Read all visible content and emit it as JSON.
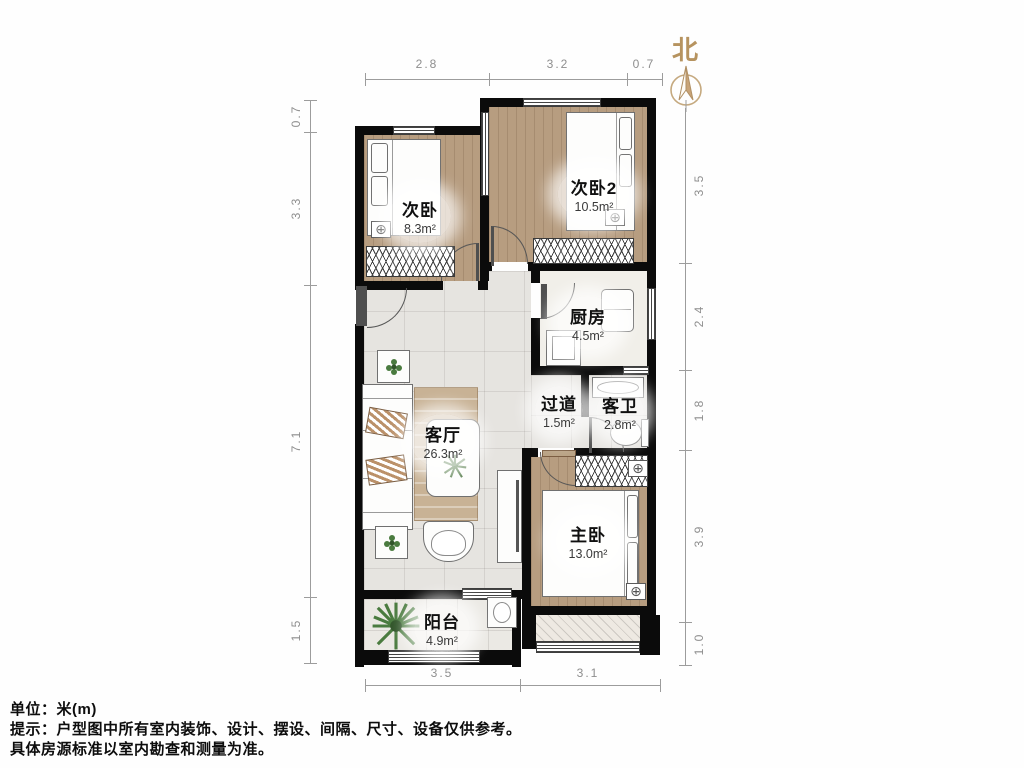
{
  "compass": {
    "north": "北"
  },
  "rooms": [
    {
      "name": "次卧",
      "area": "8.3m²"
    },
    {
      "name": "次卧2",
      "area": "10.5m²"
    },
    {
      "name": "厨房",
      "area": "4.5m²"
    },
    {
      "name": "过道",
      "area": "1.5m²"
    },
    {
      "name": "客卫",
      "area": "2.8m²"
    },
    {
      "name": "客厅",
      "area": "26.3m²"
    },
    {
      "name": "主卧",
      "area": "13.0m²"
    },
    {
      "name": "阳台",
      "area": "4.9m²"
    }
  ],
  "dimensions": {
    "top": [
      "2.8",
      "3.2",
      "0.7"
    ],
    "left": [
      "0.7",
      "3.3",
      "7.1",
      "1.5"
    ],
    "right": [
      "3.5",
      "2.4",
      "1.8",
      "3.9",
      "1.0"
    ],
    "bottom": [
      "3.5",
      "3.1"
    ]
  },
  "notes": {
    "unit": "单位：米(m)",
    "tip1": "提示：户型图中所有室内装饰、设计、摆设、间隔、尺寸、设备仅供参考。",
    "tip2": "具体房源标准以室内勘查和测量为准。"
  },
  "icons": {
    "lamp": "⊕"
  },
  "colors": {
    "wall": "#0b0b0b",
    "wood_floor": "#b79d80",
    "tile_floor": "#e6e4e0",
    "compass_accent": "#b6935f",
    "dim_text": "#8e8e8e"
  }
}
